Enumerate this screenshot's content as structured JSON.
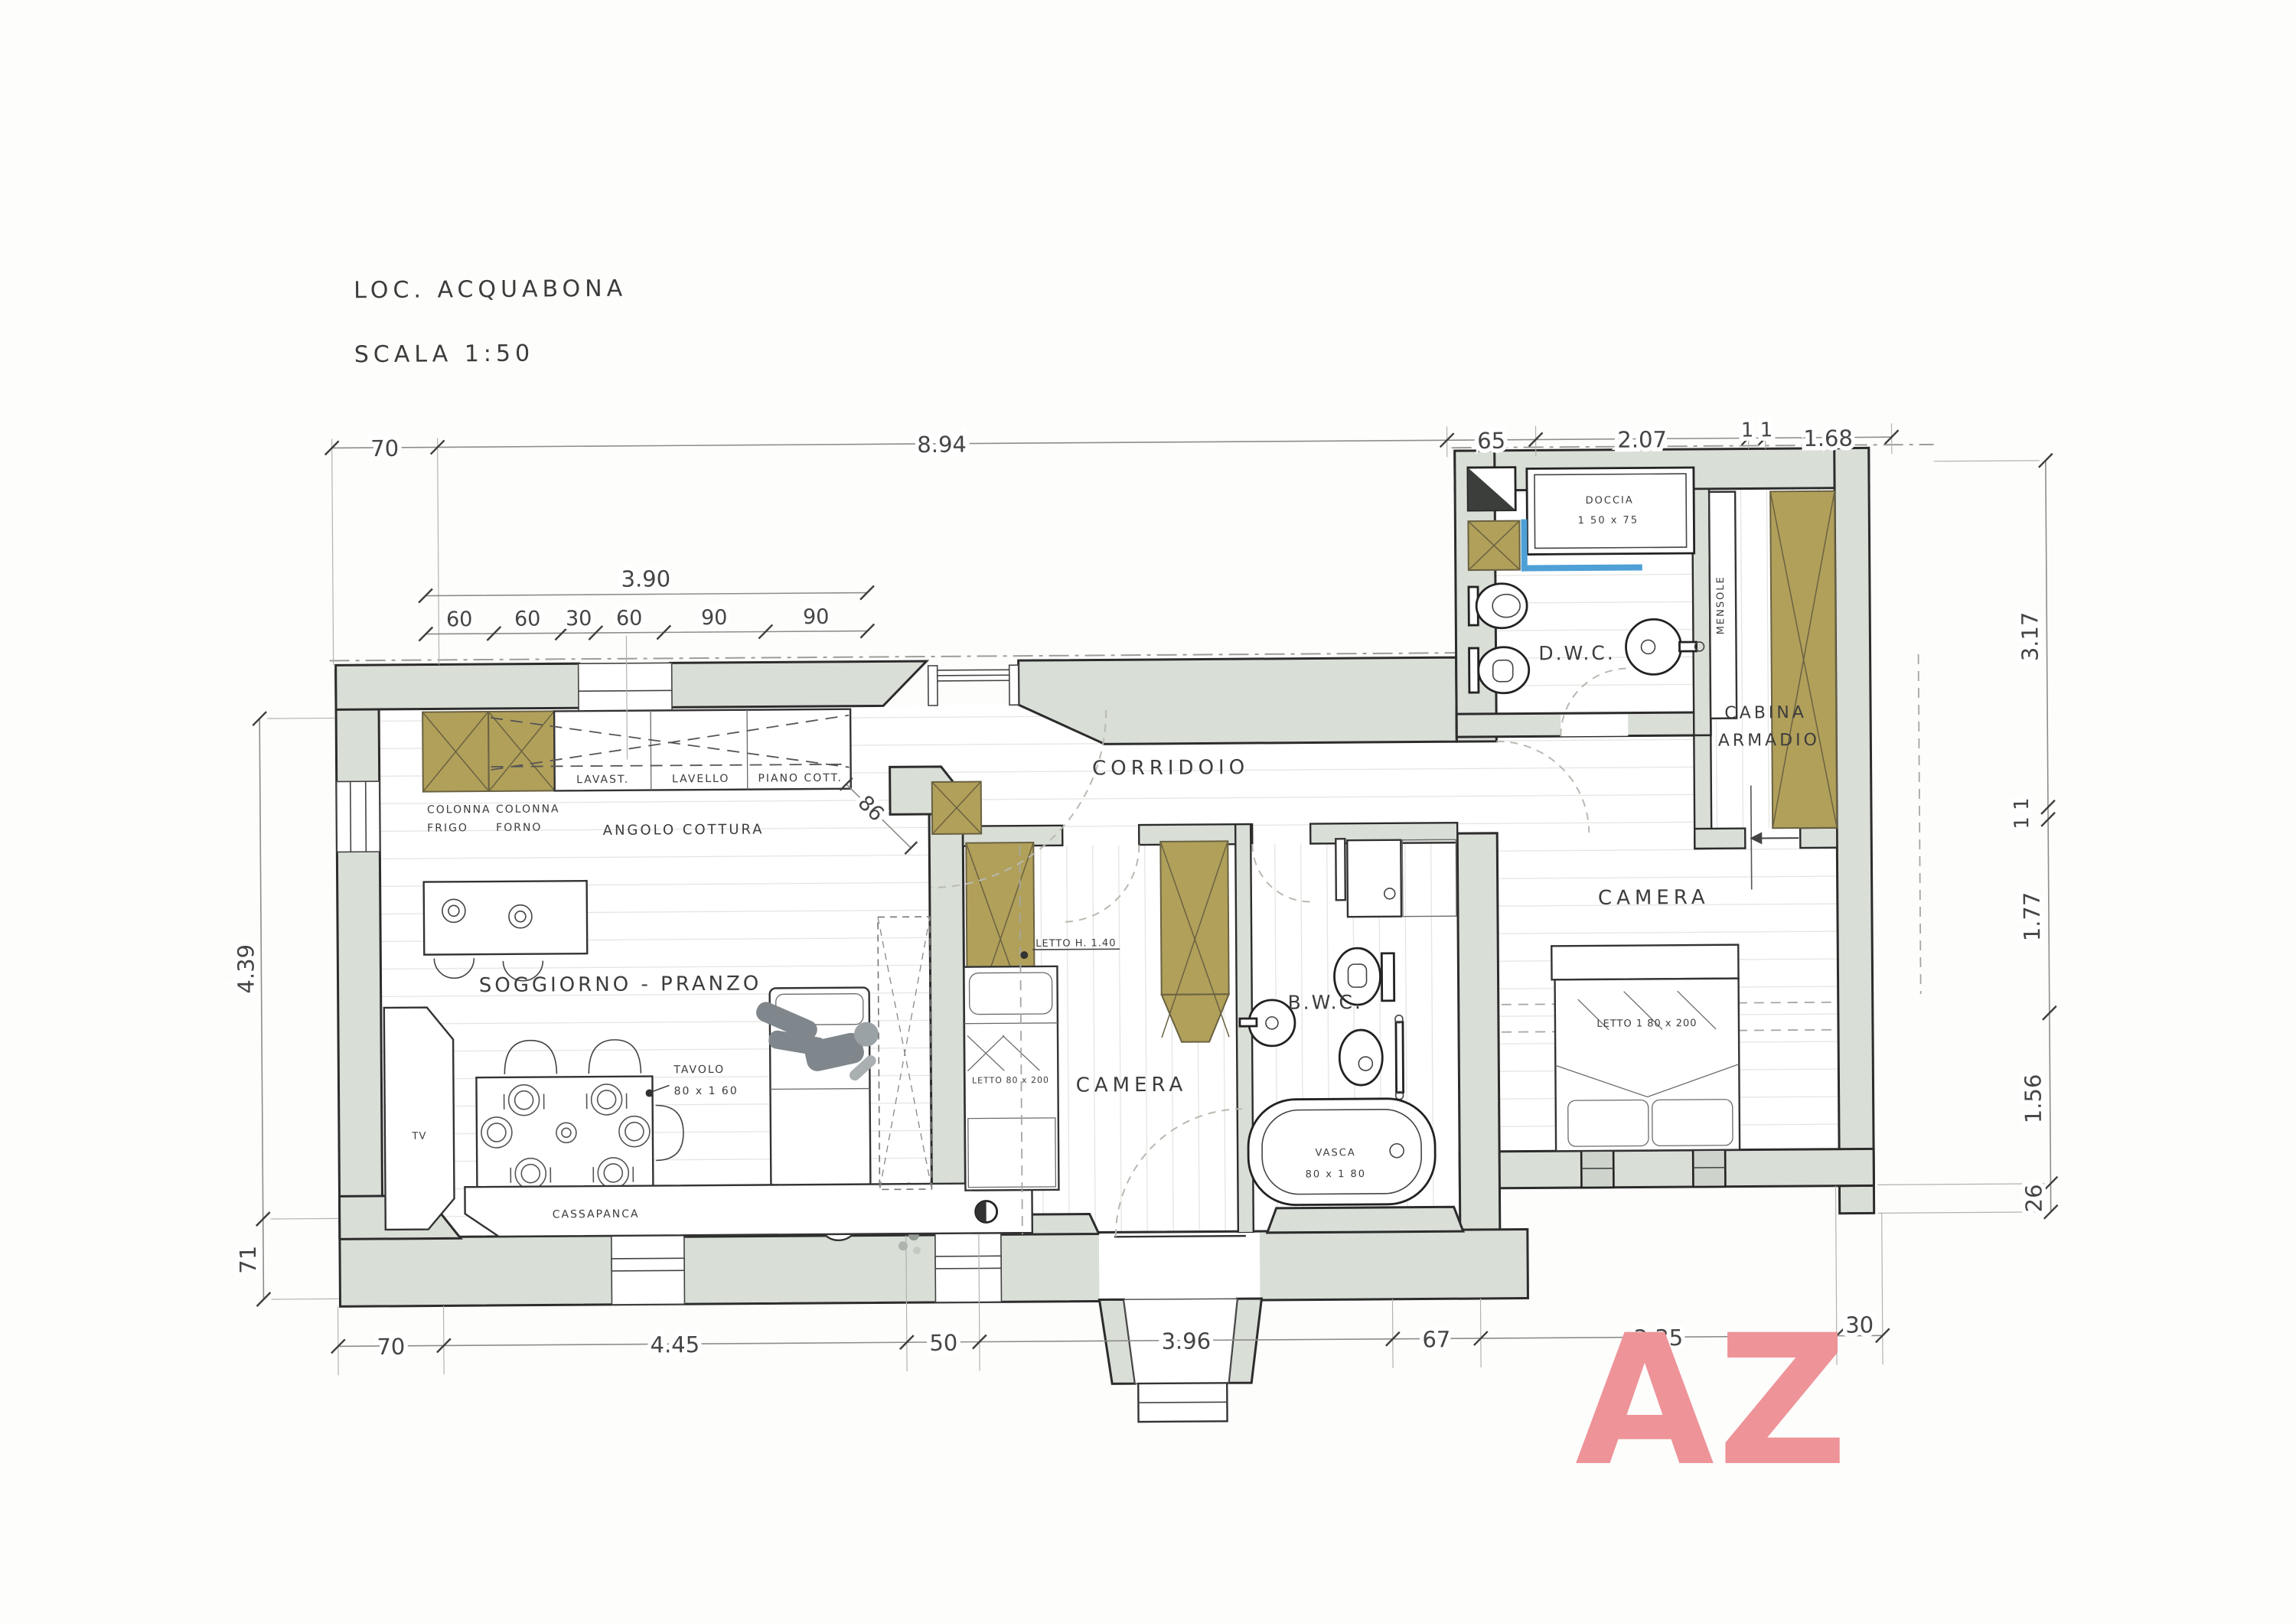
{
  "page": {
    "title": "LOC. ACQUABONA",
    "scale": "SCALA 1:50"
  },
  "watermark": {
    "text": "AZ",
    "color": "#ee9398"
  },
  "colors": {
    "wall_fill": "#d9ded7",
    "wall_stroke": "#2c2c2c",
    "wardrobe_olive": "#b1a05a",
    "shower_blue": "#4ea0d6",
    "watermark_pink": "#ee9398"
  },
  "rooms": {
    "soggiorno": "SOGGIORNO - PRANZO",
    "angolo_cottura": "ANGOLO COTTURA",
    "corridoio": "CORRIDOIO",
    "camera_1": "CAMERA",
    "bwc": "B.W.C.",
    "dwc": "D.W.C.",
    "cabina_line1": "CABINA",
    "cabina_line2": "ARMADIO",
    "camera_2": "CAMERA"
  },
  "furniture": {
    "colonna_frigo_line1": "COLONNA",
    "colonna_frigo_line2": "FRIGO",
    "colonna_forno_line1": "COLONNA",
    "colonna_forno_line2": "FORNO",
    "lavastoviglie": "LAVAST.",
    "lavello": "LAVELLO",
    "piano_cottura": "PIANO COTT.",
    "tavolo_line1": "TAVOLO",
    "tavolo_line2": "80 x 1 60",
    "cassapanca": "CASSAPANCA",
    "tv": "TV",
    "letto_h": "LETTO H. 1.40",
    "letto_singolo": "LETTO 80 x 200",
    "vasca_line1": "VASCA",
    "vasca_line2": "80 x 1 80",
    "doccia_line1": "DOCCIA",
    "doccia_line2": "1 50 x 75",
    "mensole": "MENSOLE",
    "letto_matrimoniale": "LETTO 1 80 x 200"
  },
  "dimensions": {
    "top": [
      "70",
      "8.94",
      "65",
      "2.07",
      "1 1",
      "1.68"
    ],
    "kitchen_total": "3.90",
    "kitchen_parts": [
      "60",
      "60",
      "30",
      "60",
      "90",
      "90"
    ],
    "kitchen_diagonal": "86",
    "left": [
      "4.39",
      "71"
    ],
    "right": [
      "3.17",
      "1 1",
      "1.77",
      "1.56",
      "26"
    ],
    "bottom": [
      "70",
      "4.45",
      "50",
      "3.96",
      "67",
      "3.35",
      "30"
    ]
  }
}
